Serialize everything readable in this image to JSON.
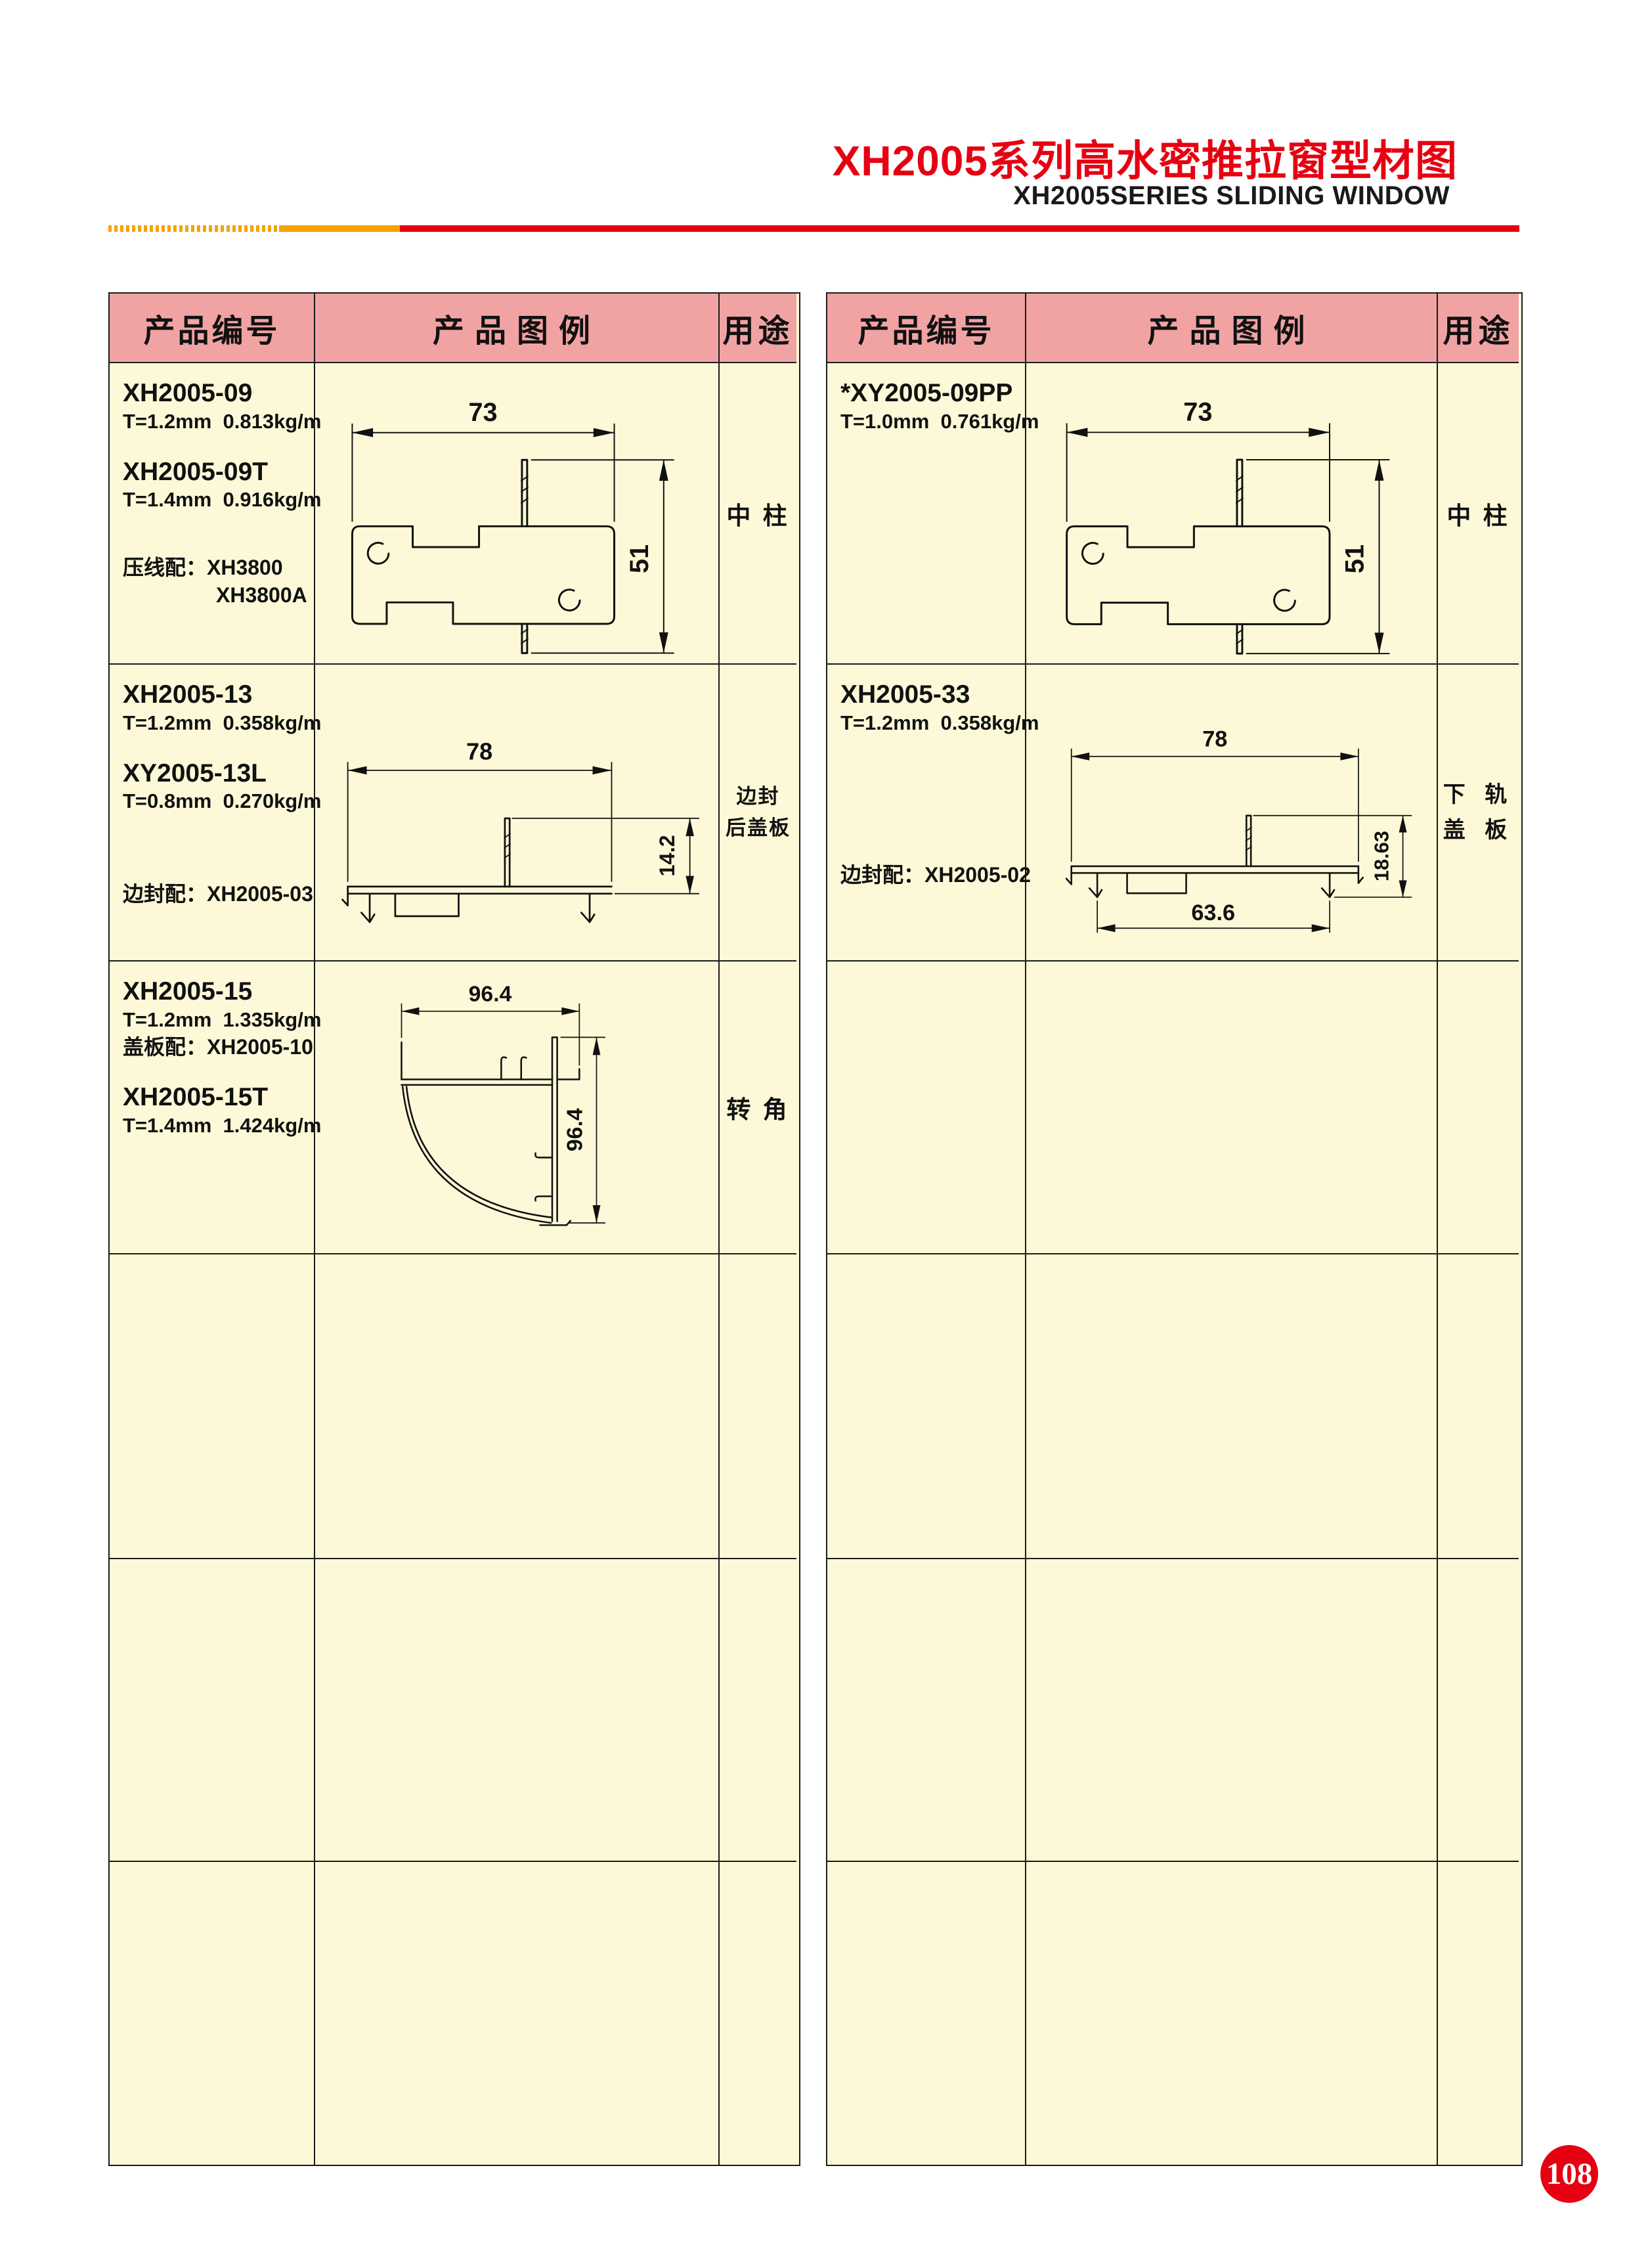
{
  "header": {
    "title": "XH2005系列高水密推拉窗型材图",
    "subtitle": "XH2005SERIES SLIDING WINDOW"
  },
  "page_number": "108",
  "colors": {
    "accent_red": "#e60012",
    "bar_orange": "#f5a300",
    "header_pink": "#f1a3a4",
    "cell_cream": "#fdf9d8"
  },
  "table_headers": {
    "col_code": "产品编号",
    "col_diagram": "产品图例",
    "col_use": "用途"
  },
  "left_table": {
    "rows": [
      {
        "code1": "XH2005-09",
        "spec1": "T=1.2mm  0.813kg/m",
        "code2": "XH2005-09T",
        "spec2": "T=1.4mm  0.916kg/m",
        "note1": "压线配：XH3800",
        "note2": "XH3800A",
        "use1": "中 柱",
        "dim_w": "73",
        "dim_h": "51"
      },
      {
        "code1": "XH2005-13",
        "spec1": "T=1.2mm  0.358kg/m",
        "code2": "XY2005-13L",
        "spec2": "T=0.8mm  0.270kg/m",
        "note1": "边封配：XH2005-03",
        "use_line1": "边封",
        "use_line2": "后盖板",
        "dim_w": "78",
        "dim_h": "14.2"
      },
      {
        "code1": "XH2005-15",
        "spec1": "T=1.2mm  1.335kg/m",
        "note1": "盖板配：XH2005-10",
        "code2": "XH2005-15T",
        "spec2": "T=1.4mm  1.424kg/m",
        "use1": "转 角",
        "dim_w": "96.4",
        "dim_h": "96.4"
      }
    ]
  },
  "right_table": {
    "rows": [
      {
        "code1": "*XY2005-09PP",
        "spec1": "T=1.0mm  0.761kg/m",
        "use1": "中 柱",
        "dim_w": "73",
        "dim_h": "51"
      },
      {
        "code1": "XH2005-33",
        "spec1": "T=1.2mm  0.358kg/m",
        "note1": "边封配：XH2005-02",
        "use_line1": "下 轨",
        "use_line2": "盖 板",
        "dim_w": "78",
        "dim_h": "18.63",
        "dim_b": "63.6"
      }
    ]
  }
}
